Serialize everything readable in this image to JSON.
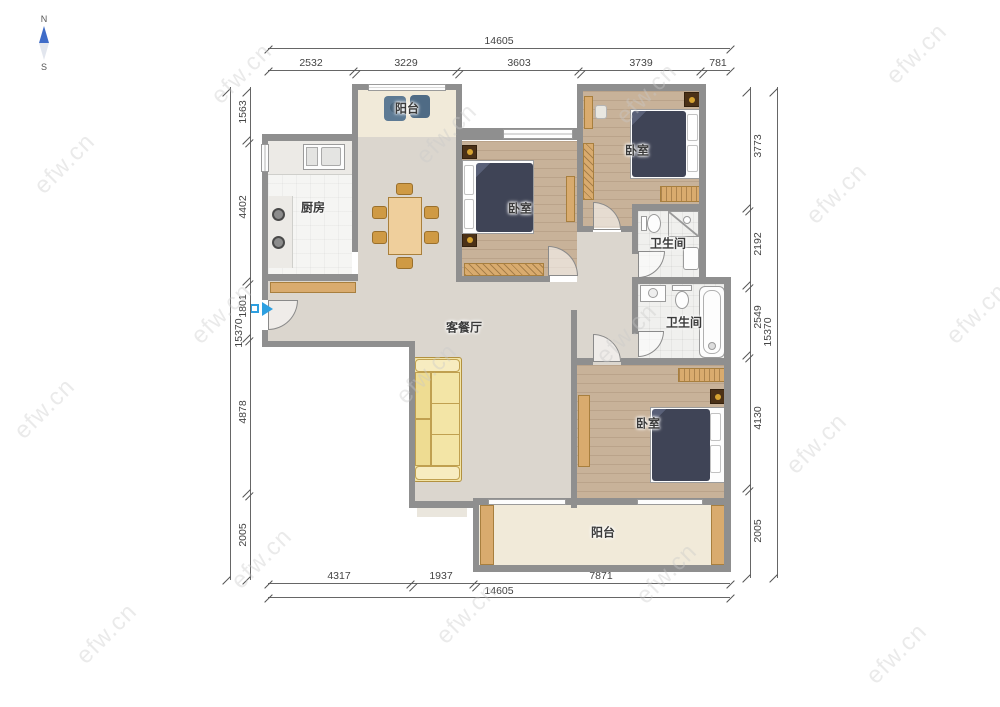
{
  "compass": {
    "north_label": "N",
    "south_label": "S"
  },
  "watermark": {
    "text": "efw.cn"
  },
  "rooms": {
    "balcony_top": "阳台",
    "kitchen": "厨房",
    "bedroom_mid": "卧室",
    "bedroom_top_right": "卧室",
    "bathroom_top": "卫生间",
    "bathroom_mid": "卫生间",
    "living_dining": "客餐厅",
    "bedroom_bottom": "卧室",
    "balcony_bottom": "阳台"
  },
  "dimensions": {
    "top": {
      "overall": "14605",
      "segments": [
        "2532",
        "3229",
        "3603",
        "3739",
        "781"
      ]
    },
    "bottom": {
      "overall": "14605",
      "segments": [
        "4317",
        "1937",
        "7871"
      ]
    },
    "left": {
      "overall": "15370",
      "segments": [
        "1563",
        "4402",
        "1801",
        "4878",
        "2005"
      ]
    },
    "right": {
      "overall": "15370",
      "segments": [
        "3773",
        "2192",
        "2549",
        "4130",
        "2005"
      ]
    }
  },
  "colors": {
    "wall": "#8f8f8f",
    "wood_floor": "#c8b299",
    "living_floor": "#dbd6ce",
    "balcony_floor": "#f1ead9",
    "bath_floor": "#f0f0ee",
    "kitchen_floor": "#f5f5f3",
    "bed_duvet": "#3f4456",
    "furniture_tan": "#d9ab6e",
    "sofa_yellow": "#f3e5a6",
    "entry_marker_blue": "#2d9fe0",
    "compass_needle_blue": "#3f6cc8",
    "dimension_text": "#444444",
    "watermark_gray": "#c9c9c9"
  }
}
